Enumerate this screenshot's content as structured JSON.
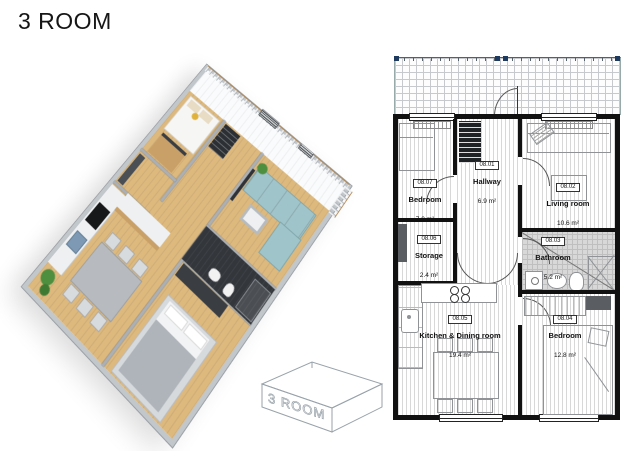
{
  "title": "3 ROOM",
  "mini_box": {
    "label": "3 ROOM"
  },
  "rooms": [
    {
      "id": "08.01",
      "name": "Hallway",
      "area": "6.9 m²"
    },
    {
      "id": "08.02",
      "name": "Living room",
      "area": "10.6 m²"
    },
    {
      "id": "08.03",
      "name": "Bathroom",
      "area": "5.2 m²"
    },
    {
      "id": "08.04",
      "name": "Bedroom",
      "area": "12.8 m²"
    },
    {
      "id": "08.05",
      "name": "Kitchen & Dining room",
      "area": "19.4 m²"
    },
    {
      "id": "08.06",
      "name": "Storage",
      "area": "2.4 m²"
    },
    {
      "id": "08.07",
      "name": "Bedroom",
      "area": "7.0 m²"
    }
  ],
  "colors": {
    "wood": "#ddb97e",
    "sofa": "#9fc4ca",
    "navy_post": "#1e3a5f",
    "rail_wood": "#a97a42",
    "plant": "#4e8f3f",
    "tile_gray": "#d8d8d8",
    "wall_black": "#111111"
  }
}
